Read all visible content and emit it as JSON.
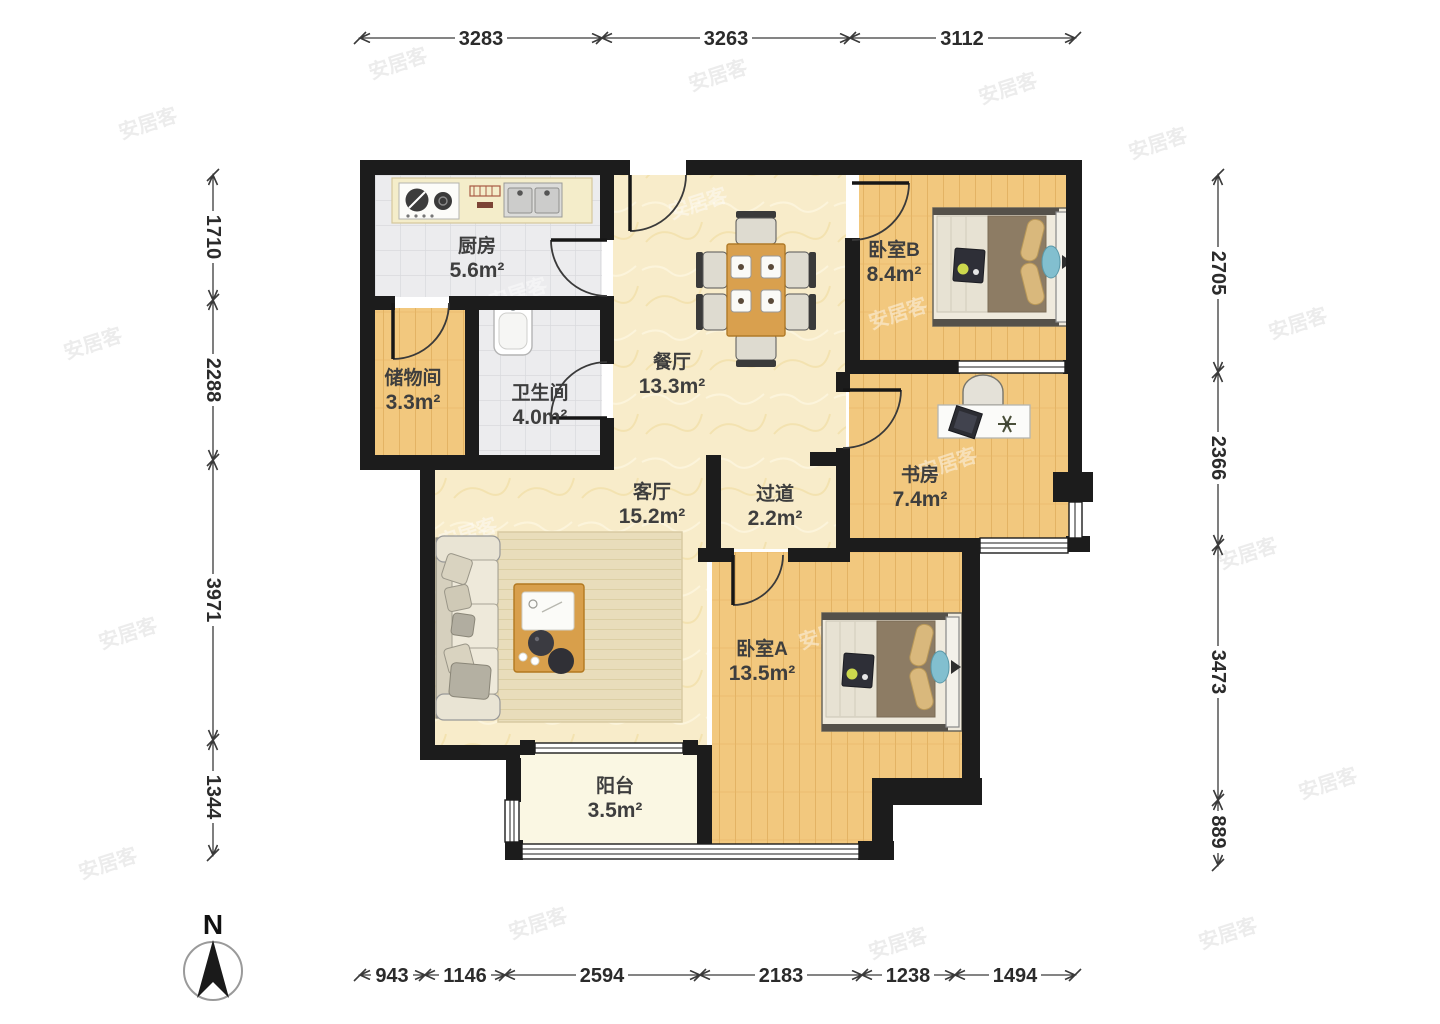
{
  "compass": {
    "label": "N"
  },
  "watermark": {
    "text": "安居客"
  },
  "rooms": [
    {
      "id": "kitchen",
      "name": "厨房",
      "area": "5.6m²"
    },
    {
      "id": "storage",
      "name": "储物间",
      "area": "3.3m²"
    },
    {
      "id": "bathroom",
      "name": "卫生间",
      "area": "4.0m²"
    },
    {
      "id": "dining",
      "name": "餐厅",
      "area": "13.3m²"
    },
    {
      "id": "bedroom-b",
      "name": "卧室B",
      "area": "8.4m²"
    },
    {
      "id": "study",
      "name": "书房",
      "area": "7.4m²"
    },
    {
      "id": "living",
      "name": "客厅",
      "area": "15.2m²"
    },
    {
      "id": "hallway",
      "name": "过道",
      "area": "2.2m²"
    },
    {
      "id": "bedroom-a",
      "name": "卧室A",
      "area": "13.5m²"
    },
    {
      "id": "balcony",
      "name": "阳台",
      "area": "3.5m²"
    }
  ],
  "dimensions": {
    "top": [
      "3283",
      "3263",
      "3112"
    ],
    "left": [
      "1710",
      "2288",
      "3971",
      "1344"
    ],
    "right": [
      "2705",
      "2366",
      "3473",
      "889"
    ],
    "bottom": [
      "943",
      "1146",
      "2594",
      "2183",
      "1238",
      "1494"
    ]
  },
  "colors": {
    "wall": "#1c1c1c",
    "wood_floor": "#f2c87e",
    "tile_floor": "#ececee",
    "cream_floor": "#f8ecca",
    "balcony_floor": "#faf7e3",
    "bed_blanket": "#8d7c64",
    "pillow": "#d9b87c",
    "accent_blue": "#82bfcf",
    "table_wood": "#d89f4b",
    "dimension_text": "#2b2b2b",
    "label_text": "#3e3e3e"
  }
}
